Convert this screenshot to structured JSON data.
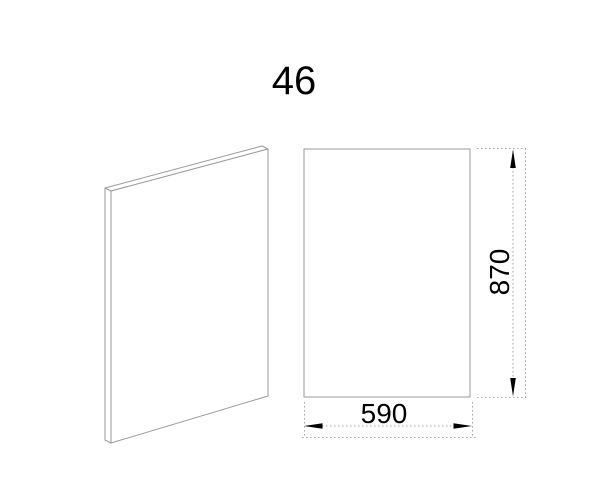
{
  "title": "46",
  "dimensions": {
    "height": {
      "value": "870",
      "orientation": "vertical"
    },
    "width": {
      "value": "590",
      "orientation": "horizontal"
    }
  },
  "icons": {
    "arrow-up-icon": "▲",
    "arrow-down-icon": "▼",
    "arrow-left-icon": "◀",
    "arrow-right-icon": "▶"
  },
  "colors": {
    "background": "#ffffff",
    "outline": "#9a9a9a",
    "dimension": "#a6a6a6",
    "arrow": "#000000",
    "text": "#000000"
  }
}
